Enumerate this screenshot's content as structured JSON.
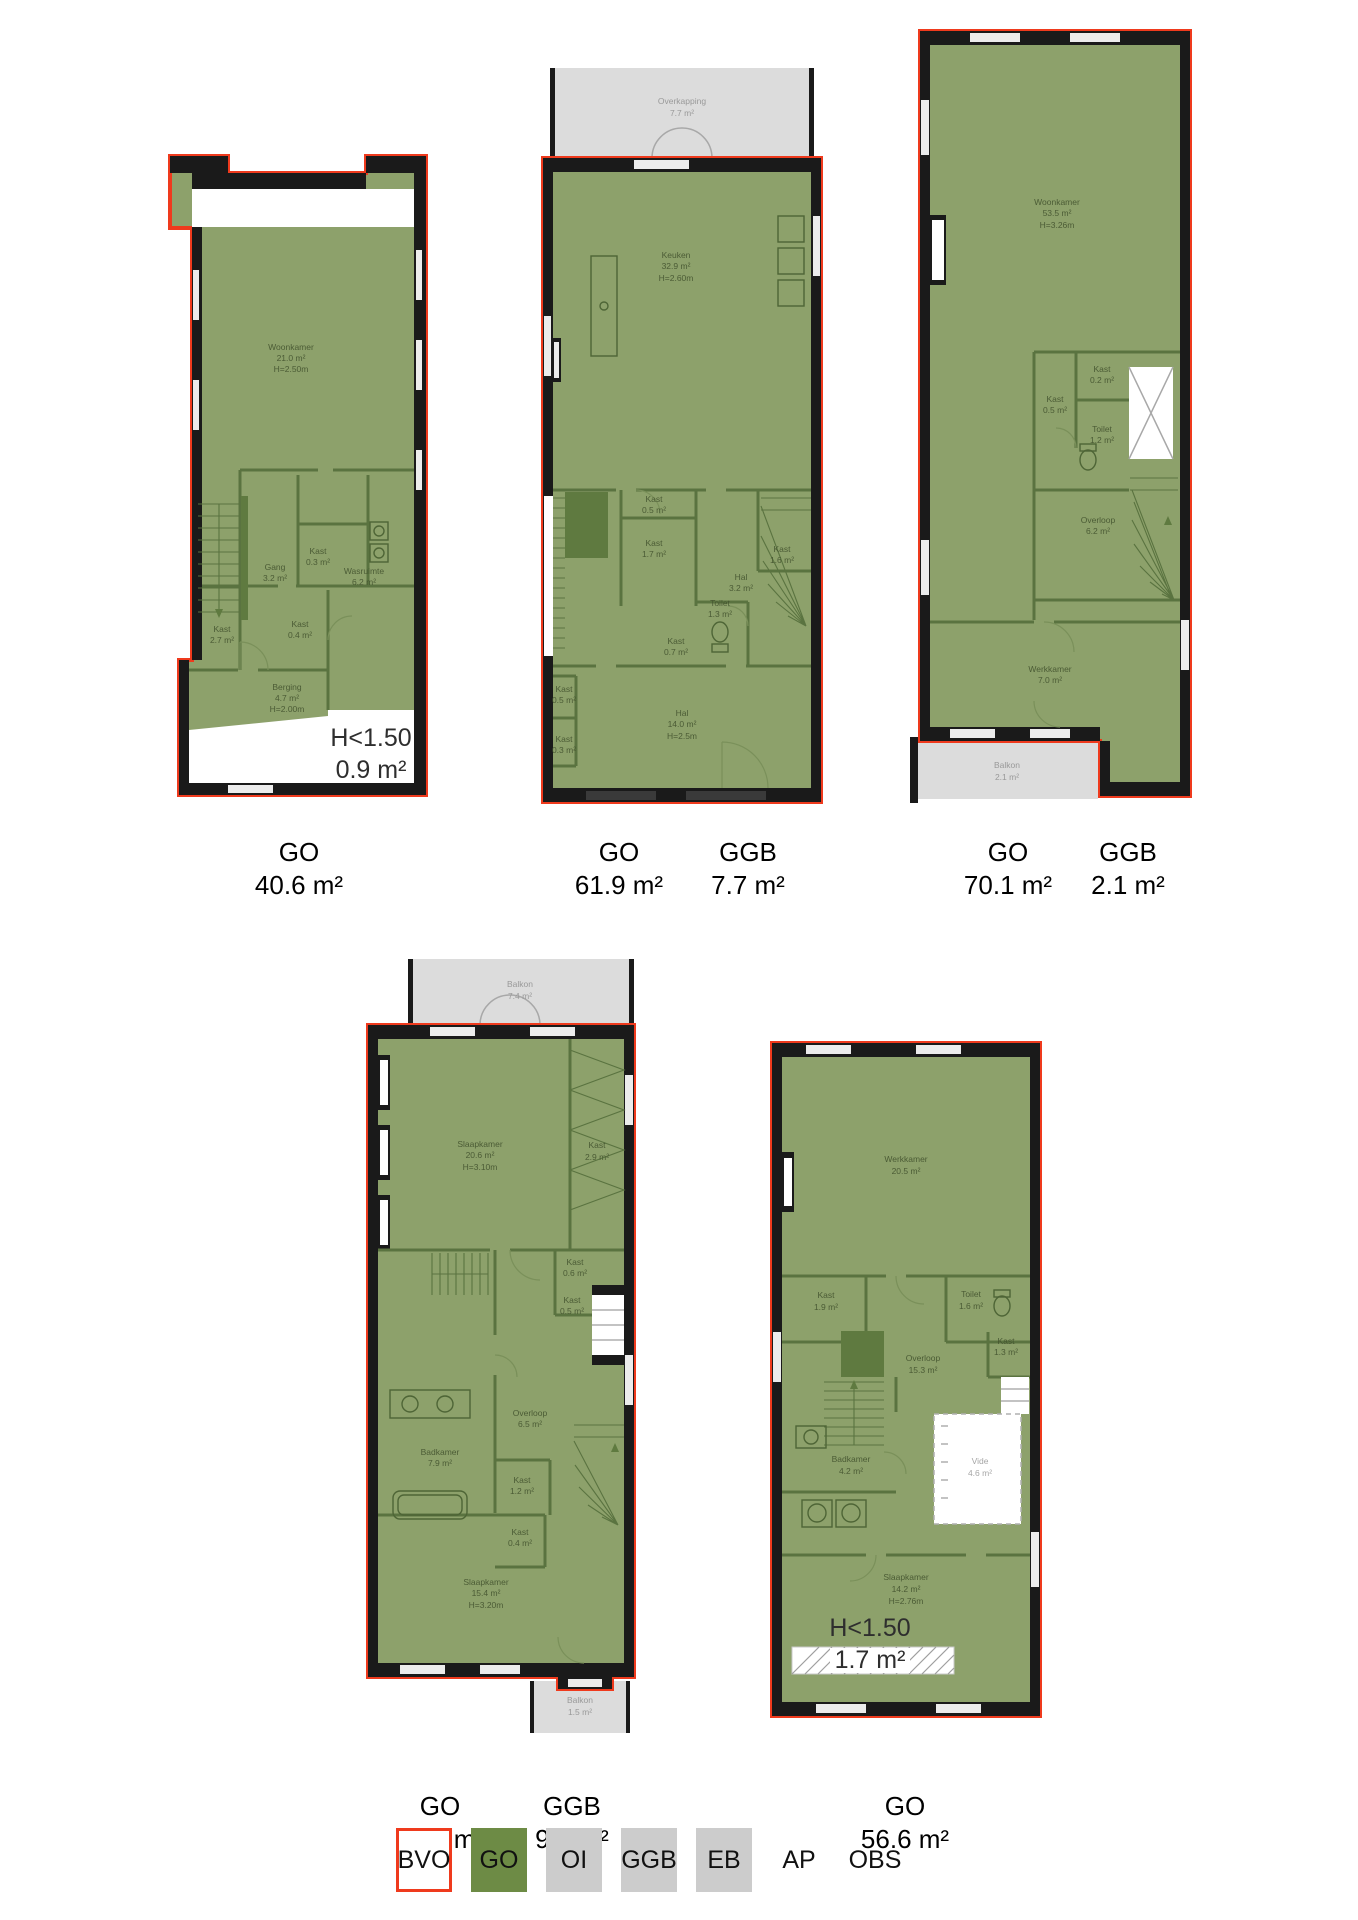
{
  "palette": {
    "outline_red": "#ef3a1d",
    "floor_green": "#8da16b",
    "legend_green": "#6d8b45",
    "interior_wall_green": "#5a7340",
    "wall_black": "#1a1a1a",
    "outside_gray": "#dcdcdc",
    "legend_gray": "#cccccc"
  },
  "plans": [
    {
      "title": "floorplan-1",
      "rooms": [
        {
          "name": "Woonkamer",
          "area": "21.0 m²",
          "height": "H=2.50m"
        },
        {
          "name": "Gang",
          "area": "3.2 m²"
        },
        {
          "name": "Kast",
          "area": "0.3 m²"
        },
        {
          "name": "Wasruimte",
          "area": "6.2 m²"
        },
        {
          "name": "Kast",
          "area": "0.4 m²"
        },
        {
          "name": "Kast",
          "area": "2.7 m²"
        },
        {
          "name": "Berging",
          "area": "4.7 m²",
          "height": "H=2.00m"
        }
      ],
      "annotation": {
        "line1": "H<1.50",
        "line2": "0.9 m²"
      },
      "metrics": [
        {
          "label": "GO",
          "value": "40.6 m²"
        }
      ]
    },
    {
      "title": "floorplan-2",
      "outside": {
        "name": "Overkapping",
        "area": "7.7 m²"
      },
      "rooms": [
        {
          "name": "Keuken",
          "area": "32.9 m²",
          "height": "H=2.60m"
        },
        {
          "name": "Kast",
          "area": "0.5 m²"
        },
        {
          "name": "Kast",
          "area": "1.7 m²"
        },
        {
          "name": "Hal",
          "area": "3.2 m²"
        },
        {
          "name": "Kast",
          "area": "1.6 m²"
        },
        {
          "name": "Toilet",
          "area": "1.3 m²"
        },
        {
          "name": "Kast",
          "area": "0.7 m²"
        },
        {
          "name": "Kast",
          "area": "0.5 m²"
        },
        {
          "name": "Kast",
          "area": "0.3 m²"
        },
        {
          "name": "Hal",
          "area": "14.0 m²",
          "height": "H=2.5m"
        }
      ],
      "metrics": [
        {
          "label": "GO",
          "value": "61.9 m²"
        },
        {
          "label": "GGB",
          "value": "7.7 m²"
        }
      ]
    },
    {
      "title": "floorplan-3",
      "rooms": [
        {
          "name": "Woonkamer",
          "area": "53.5 m²",
          "height": "H=3.26m"
        },
        {
          "name": "Kast",
          "area": "0.2 m²"
        },
        {
          "name": "Kast",
          "area": "0.5 m²"
        },
        {
          "name": "Toilet",
          "area": "1.2 m²"
        },
        {
          "name": "Overloop",
          "area": "6.2 m²"
        },
        {
          "name": "Werkkamer",
          "area": "7.0 m²"
        }
      ],
      "outside": {
        "name": "Balkon",
        "area": "2.1 m²"
      },
      "metrics": [
        {
          "label": "GO",
          "value": "70.1 m²"
        },
        {
          "label": "GGB",
          "value": "2.1 m²"
        }
      ]
    },
    {
      "title": "floorplan-4",
      "outside_top": {
        "name": "Balkon",
        "area": "7.4 m²"
      },
      "outside_bottom": {
        "name": "Balkon",
        "area": "1.5 m²"
      },
      "rooms": [
        {
          "name": "Slaapkamer",
          "area": "20.6 m²",
          "height": "H=3.10m"
        },
        {
          "name": "Kast",
          "area": "2.9 m²"
        },
        {
          "name": "Kast",
          "area": "0.6 m²"
        },
        {
          "name": "Kast",
          "area": "0.5 m²"
        },
        {
          "name": "Badkamer",
          "area": "7.9 m²"
        },
        {
          "name": "Overloop",
          "area": "6.5 m²"
        },
        {
          "name": "Kast",
          "area": "1.2 m²"
        },
        {
          "name": "Kast",
          "area": "0.4 m²"
        },
        {
          "name": "Slaapkamer",
          "area": "15.4 m²",
          "height": "H=3.20m"
        }
      ],
      "metrics": [
        {
          "label": "GO",
          "value": "61.7 m²"
        },
        {
          "label": "GGB",
          "value": "9.0 m²"
        }
      ]
    },
    {
      "title": "floorplan-5",
      "rooms": [
        {
          "name": "Werkkamer",
          "area": "20.5 m²"
        },
        {
          "name": "Kast",
          "area": "1.9 m²"
        },
        {
          "name": "Toilet",
          "area": "1.6 m²"
        },
        {
          "name": "Kast",
          "area": "1.3 m²"
        },
        {
          "name": "Overloop",
          "area": "15.3 m²"
        },
        {
          "name": "Badkamer",
          "area": "4.2 m²"
        },
        {
          "name": "Vide",
          "area": "4.6 m²"
        },
        {
          "name": "Slaapkamer",
          "area": "14.2 m²",
          "height": "H=2.76m"
        }
      ],
      "annotation": {
        "line1": "H<1.50",
        "line2": "1.7 m²"
      },
      "metrics": [
        {
          "label": "GO",
          "value": "56.6 m²"
        }
      ]
    }
  ],
  "legend": {
    "items": [
      {
        "label": "BVO",
        "swatch": "bvo"
      },
      {
        "label": "GO",
        "swatch": "go"
      },
      {
        "label": "OI",
        "swatch": "gray"
      },
      {
        "label": "GGB",
        "swatch": "gray"
      },
      {
        "label": "EB",
        "swatch": "gray"
      },
      {
        "label": "AP",
        "swatch": "none"
      },
      {
        "label": "OBS",
        "swatch": "none"
      }
    ]
  }
}
